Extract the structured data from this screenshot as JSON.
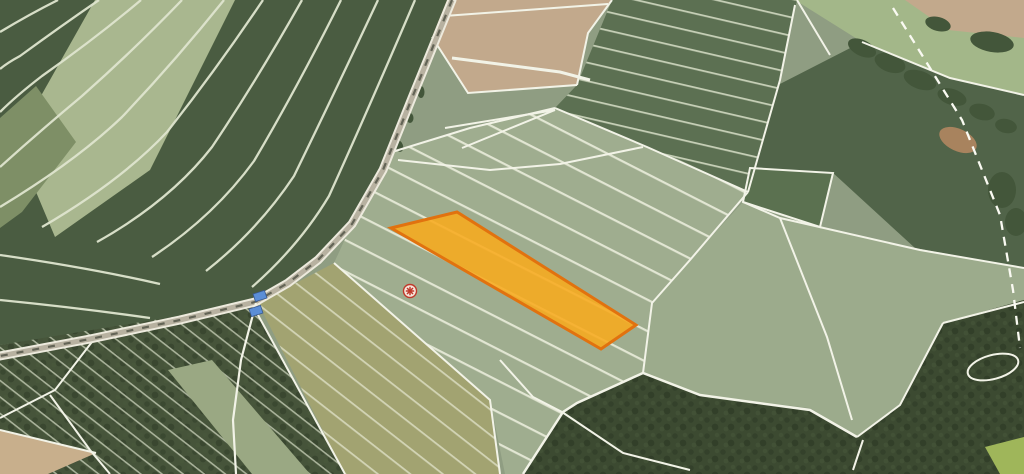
{
  "app": {
    "name": "aerial-cadastral-map-viewer",
    "view": "orthophoto-with-parcel-overlay"
  },
  "map": {
    "colors": {
      "base": "#8F9D82",
      "pale_field": "#9FAD8F",
      "plain_field": "#9CAB8C",
      "dark_top_field": "#5C7052",
      "dark_right_field": "#516449",
      "dark_square_parcel": "#5B7150",
      "top_left_field": "#4A5C41",
      "top_left_pale_strip": "#A9B78F",
      "top_left_mid_strip": "#7E8F66",
      "tan_field": "#C2A98C",
      "tan_wedge": "#C8AF8C",
      "olive_field": "#A2A371",
      "meadow": "#A3B789",
      "forest": "#3C4A31",
      "forest_sw": "#46543A",
      "forest_strip_light": "#9AA883",
      "tree_blob": "#43563A",
      "dirt_patch": "#A8835E",
      "corner_bright_field": "#9FB65A",
      "road_core": "#B7B1A0",
      "road_casing": "#EDEADD",
      "cadastral_line": "#F2F3E7",
      "road_shadow_dash": "#474B3E"
    },
    "highlighted_parcel": {
      "points": "391,228 457,212 636,325 601,349",
      "fill": "#F8AB1E",
      "fill_opacity": "0.88",
      "stroke": "#E1720F",
      "stroke_width": "3"
    },
    "marker": {
      "transform": "translate(410,291)",
      "ring_fill": "#F6E8DE",
      "color": "#C0392B",
      "radius": "6.5"
    },
    "buildings": {
      "fill": "#5B8ED6",
      "stroke": "#39598F",
      "b1_transform": "translate(260,296) rotate(-18)",
      "b2_transform": "translate(256,311) rotate(-18)"
    },
    "dashed_boundary": {
      "points": "893,8 962,120 1000,215 1013,290 1020,348",
      "dash": "9 7",
      "color": "#FAFAF2"
    },
    "roads": {
      "main_path": "M452,0 L412,98 L383,170 L352,224 L318,260 L288,283 L255,302 L180,320 L90,339 L0,356",
      "branch_path": "M256,303 L241,360 L233,420 L236,474"
    }
  }
}
